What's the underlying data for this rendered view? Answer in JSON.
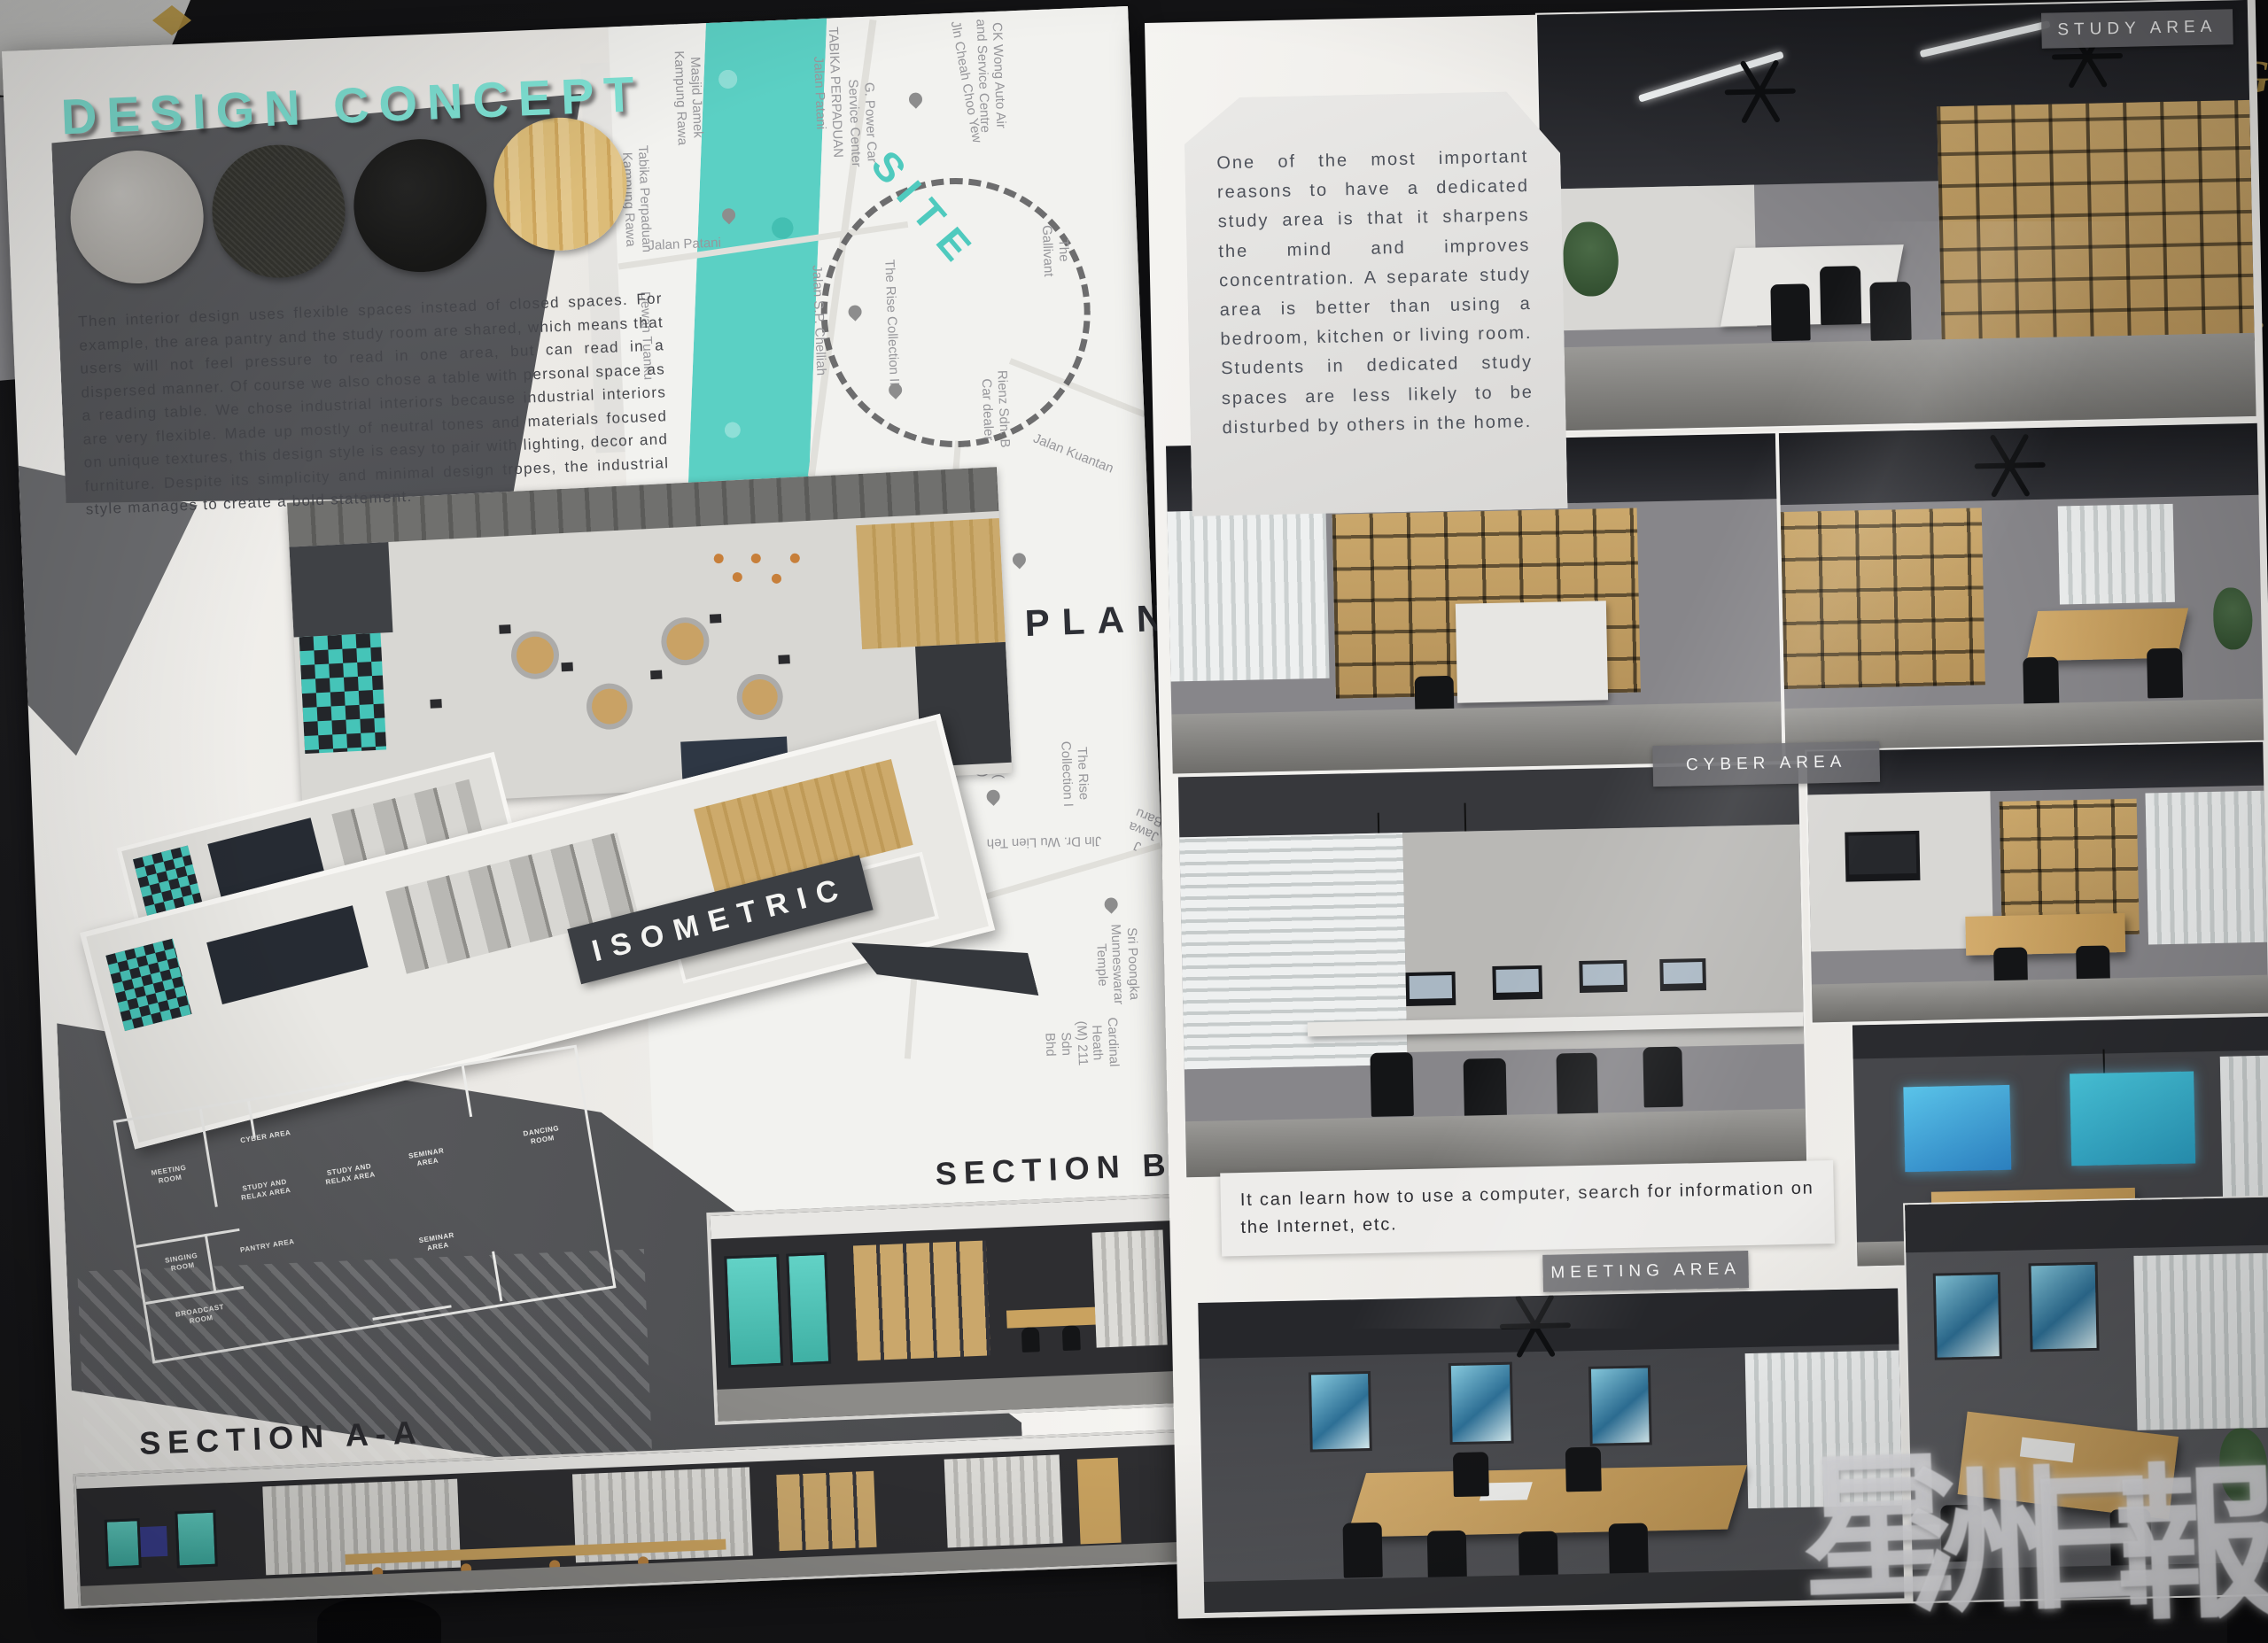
{
  "photo": {
    "watermark": [
      "星",
      "洲",
      "日",
      "報"
    ],
    "edge_fragments": [
      "G",
      "S",
      "ire",
      "on"
    ]
  },
  "colors": {
    "accent_teal": "#53CEC2",
    "title_teal": "#7FE3D5",
    "board_white": "#F3F2EF",
    "dark_panel": "#56575B",
    "wood": "#CBA76C",
    "navy": "#262B33"
  },
  "left_panel": {
    "title": "DESIGN CONCEPT",
    "materials": [
      "concrete-swatch",
      "dark-fabric-swatch",
      "black-leather-swatch",
      "light-wood-swatch"
    ],
    "concept_text": "Then interior design uses flexible spaces instead of closed spaces. For example, the area pantry and the study room are shared, which means that users will not feel pressure to read in one area, but can read in a dispersed manner. Of course we also chose a table with personal space as a reading table. We chose industrial interiors because industrial interiors are very flexible. Made up mostly of neutral tones and materials focused on unique textures, this design style is easy to pair with lighting, decor and furniture. Despite its simplicity and minimal design tropes, the industrial style manages to create a bold statement.",
    "labels": {
      "plan": "PLAN",
      "isometric": "ISOMETRIC",
      "section_bb": "SECTION B-B",
      "section_aa": "SECTION A-A"
    },
    "map": {
      "site": "SITE",
      "labels": [
        "CK Wong Auto Air\nand Service Centre",
        "The Gallivant",
        "Jln Cheah Choo Yew",
        "TABIKA PERPADUAN\nJalan Patani",
        "G. Power Car\nService Center",
        "Masjid Jamek\nKampung Rawa",
        "Tabika Perpaduan\nKampung Rawa",
        "Jalan Patani",
        "Dewan Tuanku",
        "The Rise Collection II",
        "Jalan S.P. Chelliah",
        "Rienz Sdn. B\nCar dealer",
        "Jalan Kuantan",
        "P/E The Rise 2C (\nTaman Harapan )",
        "The Rise Collection I",
        "Jln Dr. Wu Lien Teh",
        "J Jawa Baru",
        "Sri Poongka\nMunneswarar Temple",
        "Armenian Enterprise",
        "Cardinal Heath\n(M) 211 Sdn Bhd"
      ]
    },
    "floor_plan_rooms": [
      "MEETING\nROOM",
      "CYBER AREA",
      "STUDY AND\nRELAX AREA",
      "STUDY AND\nRELAX AREA",
      "SEMINAR\nAREA",
      "SINGING\nROOM",
      "PANTRY AREA",
      "SEMINAR\nAREA",
      "BROADCAST\nROOM",
      "DANCING\nROOM"
    ]
  },
  "right_panel": {
    "study_text": "One of the most important reasons to have a dedicated study area is that it sharpens the mind and improves concentration. A separate study area is better than using a bedroom, kitchen or living room. Students in dedicated study spaces are less likely to be disturbed by others in the home.",
    "cyber_text": "It can learn how to use a computer, search for information on the Internet, etc.",
    "area_labels": {
      "study": "STUDY AREA",
      "cyber": "CYBER AREA",
      "meeting": "MEETING AREA"
    }
  }
}
